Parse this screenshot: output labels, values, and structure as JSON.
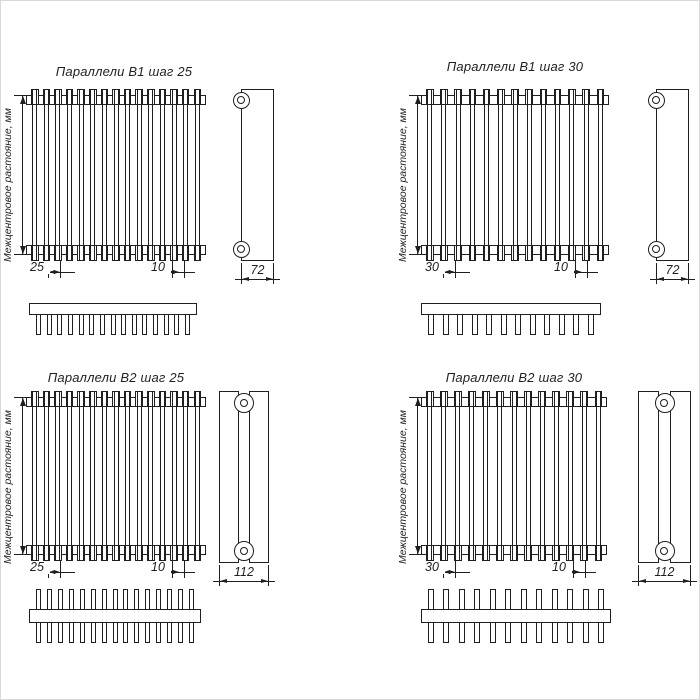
{
  "axis_label": "Межцентровое растояние, мм",
  "line_color": "#1f1f1f",
  "panels": [
    {
      "title": "Параллели В1 шаг 25",
      "variant": "В1",
      "step": "25",
      "tubes": 15,
      "teeth": 15,
      "rows": 1,
      "dim_pitch": "25",
      "dim_tube": "10",
      "dim_depth": "72"
    },
    {
      "title": "Параллели В1 шаг 30",
      "variant": "В1",
      "step": "30",
      "tubes": 13,
      "teeth": 12,
      "rows": 1,
      "dim_pitch": "30",
      "dim_tube": "10",
      "dim_depth": "72"
    },
    {
      "title": "Параллели В2 шаг 25",
      "variant": "В2",
      "step": "25",
      "tubes": 15,
      "teeth": 15,
      "rows": 2,
      "dim_pitch": "25",
      "dim_tube": "10",
      "dim_depth": "112"
    },
    {
      "title": "Параллели В2 шаг 30",
      "variant": "В2",
      "step": "30",
      "tubes": 13,
      "teeth": 12,
      "rows": 2,
      "dim_pitch": "30",
      "dim_tube": "10",
      "dim_depth": "112"
    }
  ]
}
